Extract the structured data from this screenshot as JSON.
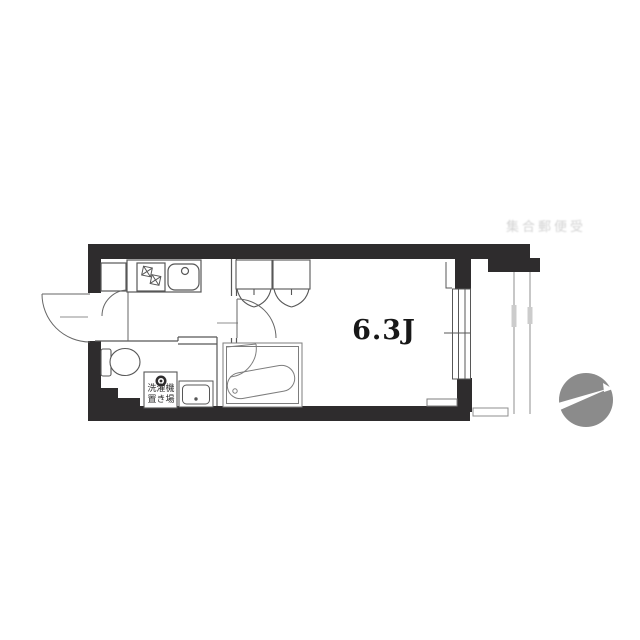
{
  "floor_plan": {
    "main_room": {
      "label": "6.3J"
    },
    "laundry": {
      "line1": "洗濯機",
      "line2": "置き場"
    },
    "faint_note": "集合郵便受",
    "colors": {
      "wall": "#2e2c2d",
      "line": "#575757",
      "unit_line": "#7d7d7d",
      "light": "#8f8f8f",
      "tab": "#cccccc",
      "compass": "#8b8b8b"
    }
  }
}
